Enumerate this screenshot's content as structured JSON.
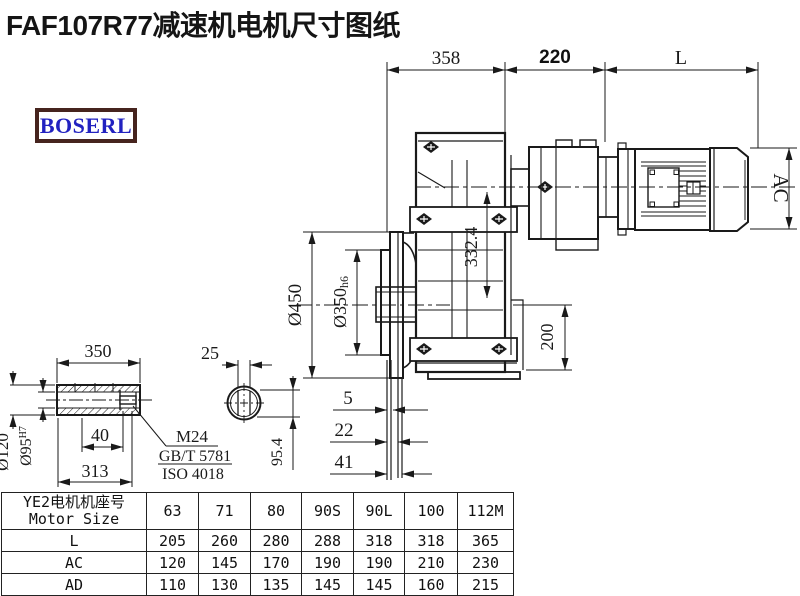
{
  "window": {
    "title": "FAF107R77减速机电机尺寸图纸"
  },
  "logo": {
    "text": "BOSERL"
  },
  "drawing": {
    "dims": {
      "len_gearbox": "358",
      "len_input": "220",
      "len_motor": "L",
      "motor_diameter": "AC",
      "flange_od": "Ø450",
      "spigot_d": "Ø350",
      "spigot_tol": "h6",
      "center_height": "332.4",
      "foot_height": "200",
      "offset_a": "5",
      "offset_b": "22",
      "offset_c": "41",
      "shaft_len": "350",
      "key_len": "40",
      "shaft_len2": "313",
      "shaft_od": "Ø120",
      "bore_d": "Ø95",
      "bore_tol": "H7",
      "key_width": "25",
      "key_height": "95.4",
      "bolt": "M24",
      "bolt_std_gb": "GB/T 5781",
      "bolt_std_iso": "ISO 4018"
    }
  },
  "table": {
    "header_cn": "YE2电机机座号",
    "header_en": "Motor Size",
    "columns": [
      "63",
      "71",
      "80",
      "90S",
      "90L",
      "100",
      "112M"
    ],
    "rows": [
      {
        "label": "L",
        "values": [
          "205",
          "260",
          "280",
          "288",
          "318",
          "318",
          "365"
        ]
      },
      {
        "label": "AC",
        "values": [
          "120",
          "145",
          "170",
          "190",
          "190",
          "210",
          "230"
        ]
      },
      {
        "label": "AD",
        "values": [
          "110",
          "130",
          "135",
          "145",
          "145",
          "160",
          "215"
        ]
      }
    ]
  }
}
